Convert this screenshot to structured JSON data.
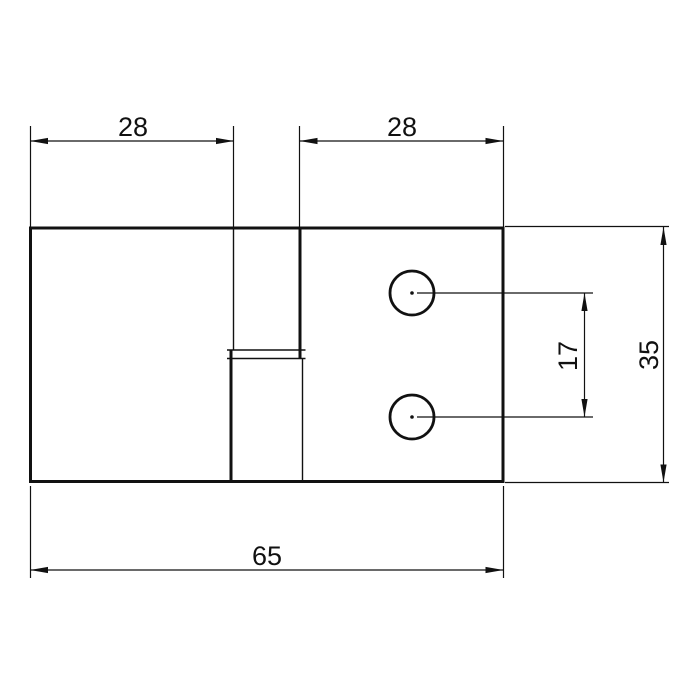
{
  "drawing": {
    "background_color": "#ffffff",
    "line_color": "#111111",
    "view": "part-top-view-with-center-slot-and-two-holes",
    "dim_labels": {
      "top_left_width": "28",
      "top_right_width": "28",
      "total_width": "65",
      "hole_spacing": "17",
      "overall_height": "35"
    },
    "features": {
      "holes_count": 2,
      "dimensions_count": 5
    }
  }
}
